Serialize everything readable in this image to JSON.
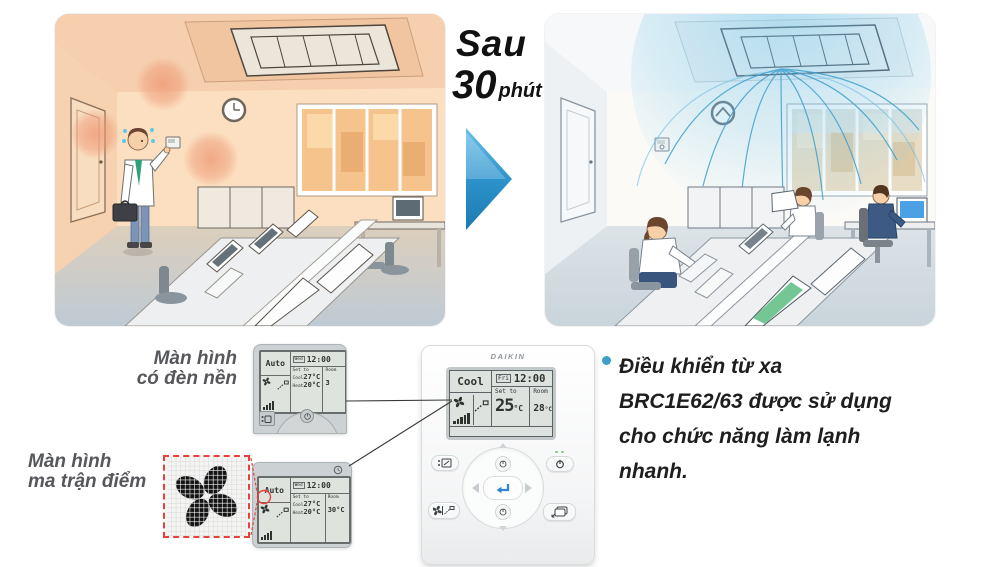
{
  "transition": {
    "word": "Sau",
    "number": "30",
    "unit": "phút"
  },
  "callouts": {
    "backlit": {
      "line1": "Màn hình",
      "line2": "có đèn nền"
    },
    "dotmatrix": {
      "line1": "Màn hình",
      "line2": "ma trận điểm"
    }
  },
  "note": {
    "bullet": "•",
    "text": "Điều khiển từ xa BRC1E62/63 được sử dụng cho chức năng làm lạnh nhanh."
  },
  "remote_backlit": {
    "mode": "Auto",
    "day": "Wed",
    "time": "12:00",
    "set_label": "Set to",
    "cool_label": "Cool",
    "cool_temp": "27°C",
    "heat_label": "Heat",
    "heat_temp": "20°C",
    "room_label": "Room",
    "room_temp": "3"
  },
  "remote_dotmatrix": {
    "mode": "Auto",
    "day": "Wed",
    "time": "12:00",
    "set_label": "Set to",
    "cool_label": "Cool",
    "cool_temp": "27°C",
    "heat_label": "Heat",
    "heat_temp": "20°C",
    "room_label": "Room",
    "room_temp": "30°C"
  },
  "remote_main": {
    "brand": "DAIKIN",
    "mode": "Cool",
    "day": "Fri",
    "time": "12:00",
    "set_label": "Set to",
    "set_temp": "25",
    "set_unit": "°C",
    "room_label": "Room",
    "room_temp": "28",
    "room_unit": "°C"
  },
  "colors": {
    "arrow_blue_light": "#6cc0e8",
    "arrow_blue_dark": "#1b7ab1",
    "accent_red": "#e8413c",
    "bullet_blue": "#3d9fc6",
    "enter_blue": "#2f86d2",
    "heat_tint": "#ef9c78",
    "cool_air": "#3f9fce"
  }
}
